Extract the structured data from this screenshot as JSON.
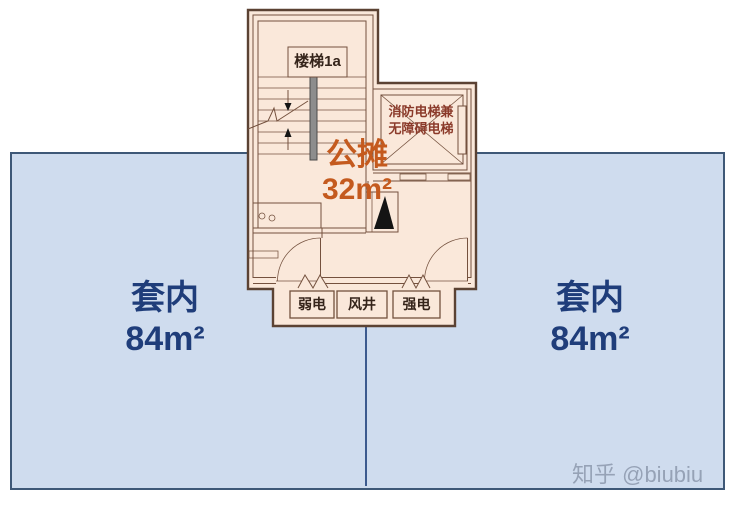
{
  "floorplan": {
    "stairwell_label": "楼梯1a",
    "elevator_label": [
      "消防电梯兼",
      "无障碍电梯"
    ],
    "shared_area": {
      "label": "公摊",
      "value": "32m²"
    },
    "utility_rooms": [
      {
        "label": "弱电"
      },
      {
        "label": "风井"
      },
      {
        "label": "强电"
      }
    ]
  },
  "suites": {
    "left": {
      "label": "套内",
      "value": "84m²"
    },
    "right": {
      "label": "套内",
      "value": "84m²"
    }
  },
  "watermark": "知乎 @biubiu",
  "colors": {
    "suite_fill": "#cfdcee",
    "suite_border": "#3e5877",
    "divider_line": "#3c5a8e",
    "plan_fill": "#fae8da",
    "plan_border": "#5b4233",
    "shared_area_text": "#c45a1e",
    "suite_text": "#1f3d7a",
    "elevator_text": "#8b3a2a",
    "watermark_text": "#8d99ad"
  }
}
